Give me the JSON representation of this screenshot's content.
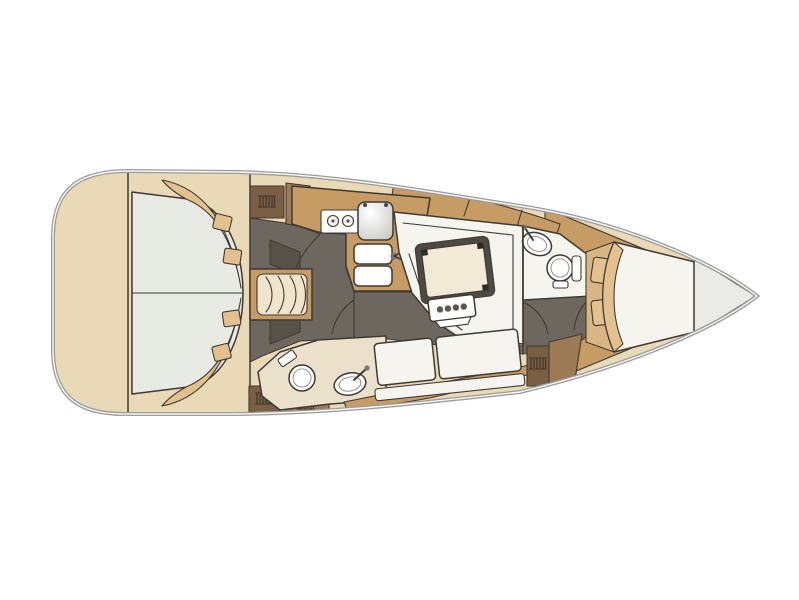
{
  "figure": {
    "type": "boat-floor-plan",
    "view": "top-down yacht interior layout",
    "legend": [
      "stern-deck",
      "aft-cabin-double-berth",
      "companionway-steps",
      "galley",
      "stove",
      "galley-sink",
      "double-sink",
      "saloon-settee",
      "saloon-table",
      "aft-heads",
      "forward-heads",
      "toilet",
      "washbasin",
      "lower-settee",
      "hanging-locker",
      "v-berth",
      "bow-locker"
    ]
  },
  "colors": {
    "page_bg": "#ffffff",
    "hull_line": "#9b9b9b",
    "hull_inner_line": "#f7f7f5",
    "deck_cream": "#e9d9b6",
    "wood": "#c79c64",
    "wood_medium": "#9c7a54",
    "wood_dark": "#7b5f45",
    "wood_light": "#d9b583",
    "floor_gray": "#6e6760",
    "floor_dark": "#58524b",
    "berth_light": "#e8ebe4",
    "white_soft": "#f6f4ee",
    "white_pure": "#ffffff",
    "cushion_tan": "#e3c18f",
    "cream_room": "#ebe1cb",
    "steps_cream": "#efe5cc",
    "table_border": "#4e4943",
    "table_top": "#f2ead7",
    "bow_locker": "#eaeae6",
    "fixture_inner": "#9a9792",
    "line": "#3f3a34",
    "hatch": "#3c3227",
    "metal": "#777777"
  }
}
